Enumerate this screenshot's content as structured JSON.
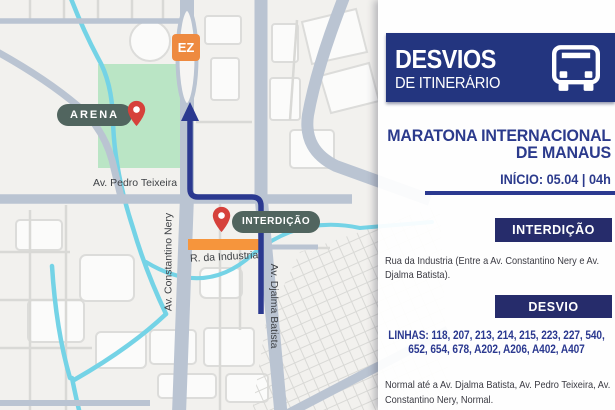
{
  "panel": {
    "header": {
      "title": "DESVIOS",
      "subtitle": "DE ITINERÁRIO",
      "bg": "#23357f",
      "icon": "bus-icon"
    },
    "event": {
      "title_line1": "MARATONA INTERNACIONAL",
      "title_line2": "DE MANAUS",
      "start": "INÍCIO: 05.04 | 04h"
    },
    "interdicao": {
      "label": "INTERDIÇÃO",
      "text": "Rua da Industria (Entre a Av. Constantino Nery e Av. Djalma Batista)."
    },
    "desvio": {
      "label": "DESVIO",
      "lines": "LINHAS: 118, 207, 213, 214, 215, 223, 227, 540, 652, 654, 678, A202, A206, A402, A407",
      "detour": "Normal até a Av. Djalma Batista, Av. Pedro Teixeira, Av. Constantino Nery, Normal."
    },
    "colors": {
      "badge_bg": "#262c6b",
      "accent": "#2b3990",
      "body_text": "#3a3a42"
    }
  },
  "map": {
    "labels": {
      "arena": "ARENA",
      "interdicao": "INTERDIÇÃO",
      "pedro_teixeira": "Av. Pedro Teixeira",
      "constantino_nery": "Av. Constantino Nery",
      "djalma_batista": "Av. Djalma Batista",
      "industria": "R. da Industria",
      "ez": "EZ"
    },
    "colors": {
      "road": "#bac4d2",
      "water": "#74d3e6",
      "green_area": "#bae5c5",
      "route": "#2b3990",
      "closure_bar": "#f6953c",
      "pin": "#d6413b",
      "pill_bg": "#51655f",
      "ez_bg": "#ee8a40",
      "background": "#f2f1ee"
    }
  }
}
